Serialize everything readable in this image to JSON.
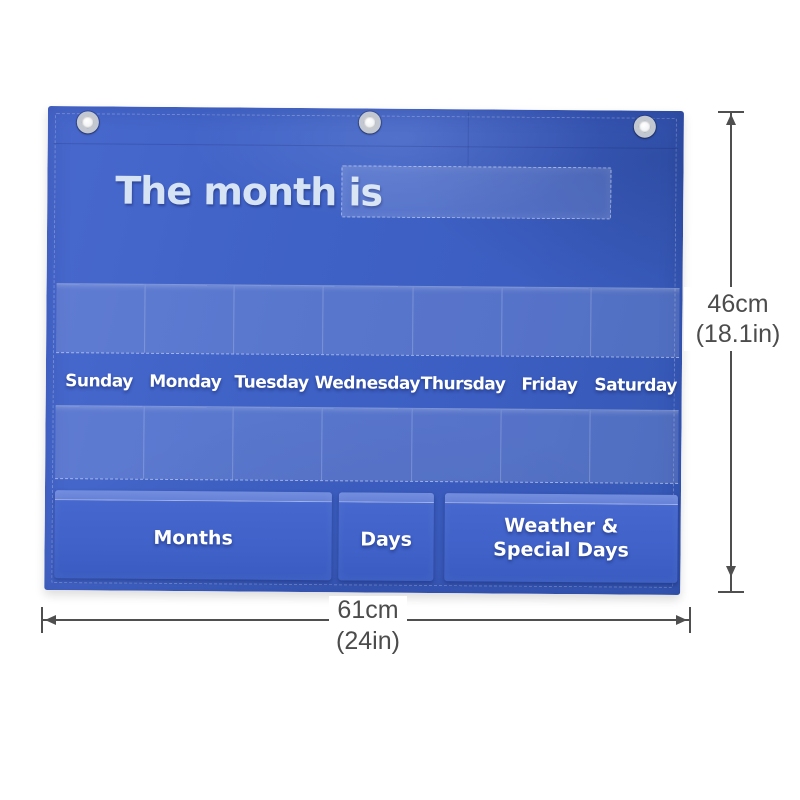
{
  "product": {
    "kind": "calendar pocket chart",
    "title_text": "The month is",
    "day_labels": [
      "Sunday",
      "Monday",
      "Tuesday",
      "Wednesday",
      "Thursday",
      "Friday",
      "Saturday"
    ],
    "clear_pocket_rows": 2,
    "clear_pockets_per_row": 7,
    "grommet_count": 3,
    "bottom_pockets": {
      "months": "Months",
      "days": "Days",
      "weather_line1": "Weather &",
      "weather_line2": "Special Days"
    },
    "colors": {
      "fabric_blue": "#3e61c5",
      "pocket_highlight_blue": "#4667cd",
      "title_text": "#d6e3f4",
      "label_text": "#ffffff"
    }
  },
  "annotations": {
    "height_value": "46cm",
    "height_alt": "(18.1in)",
    "width_value": "61cm",
    "width_alt": "(24in)",
    "line_color": "#4f4f4f",
    "text_color": "#4c4c4c"
  }
}
